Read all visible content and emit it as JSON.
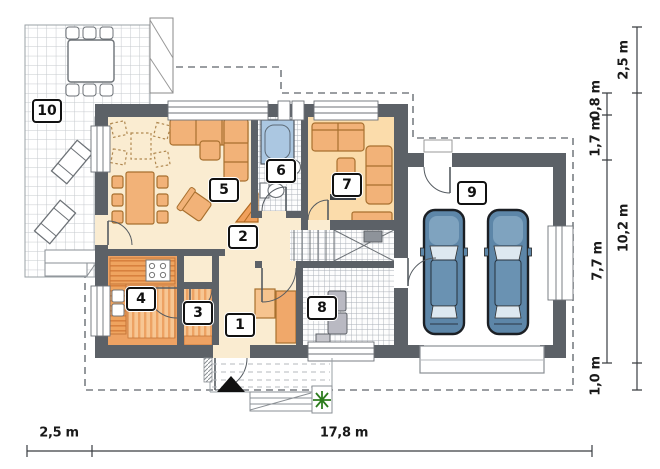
{
  "plan": {
    "type": "floor-plan",
    "room_labels": [
      {
        "id": "room-1",
        "label": "1"
      },
      {
        "id": "room-2",
        "label": "2"
      },
      {
        "id": "room-3",
        "label": "3"
      },
      {
        "id": "room-4",
        "label": "4"
      },
      {
        "id": "room-5",
        "label": "5"
      },
      {
        "id": "room-6",
        "label": "6"
      },
      {
        "id": "room-7",
        "label": "7"
      },
      {
        "id": "room-8",
        "label": "8"
      },
      {
        "id": "room-9",
        "label": "9"
      },
      {
        "id": "room-10",
        "label": "10"
      }
    ],
    "dimensions": {
      "bottom": [
        {
          "label": "2,5 m"
        },
        {
          "label": "17,8 m"
        }
      ],
      "right_outer": [
        {
          "label": "2,5 m"
        },
        {
          "label": "10,2 m"
        },
        {
          "label": "1,0 m"
        }
      ],
      "right_inner": [
        {
          "label": "0,8 m"
        },
        {
          "label": "1,7 m"
        },
        {
          "label": "7,7 m"
        }
      ]
    },
    "colors": {
      "wall": "#5c6167",
      "floor_main": "#faecd1",
      "floor_room7": "#fbdcab",
      "floor_kitchen": "#eea263",
      "furniture": "#f2b278",
      "car_body": "#5d86a8",
      "bathtub": "#abc7e1",
      "plant": "#2e7d1f",
      "dashed_roofline": "#7a7f84"
    }
  }
}
